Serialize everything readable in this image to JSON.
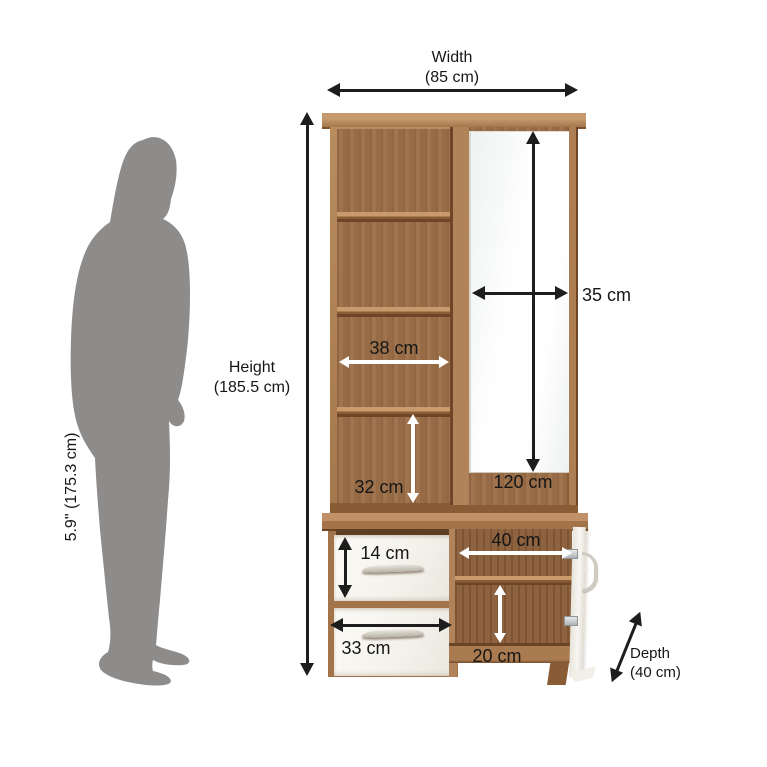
{
  "scale_figure": {
    "person_height": "5.9\" (175.3 cm)"
  },
  "dimensions": {
    "width_title": "Width",
    "width_value": "(85 cm)",
    "height_title": "Height",
    "height_value": "(185.5 cm)",
    "depth_title": "Depth",
    "depth_value": "(40 cm)",
    "mirror_width": "35 cm",
    "mirror_height": "120 cm",
    "shelf_width": "38 cm",
    "shelf_gap_height": "32 cm",
    "drawer_front_height": "14 cm",
    "drawer_width": "33 cm",
    "compartment_width": "40 cm",
    "compartment_gap_height": "20 cm"
  },
  "colors": {
    "wood_frame": "#ab7d53",
    "wood_back_panel": "#9b6e48",
    "wood_dark_edge": "#6e4527",
    "drawer_white": "#f7f5ef",
    "mirror_tint": "#f4f7f6",
    "silhouette_gray": "#8e8b8b",
    "annotation_black": "#1d1d1d",
    "annotation_white": "#ffffff"
  }
}
